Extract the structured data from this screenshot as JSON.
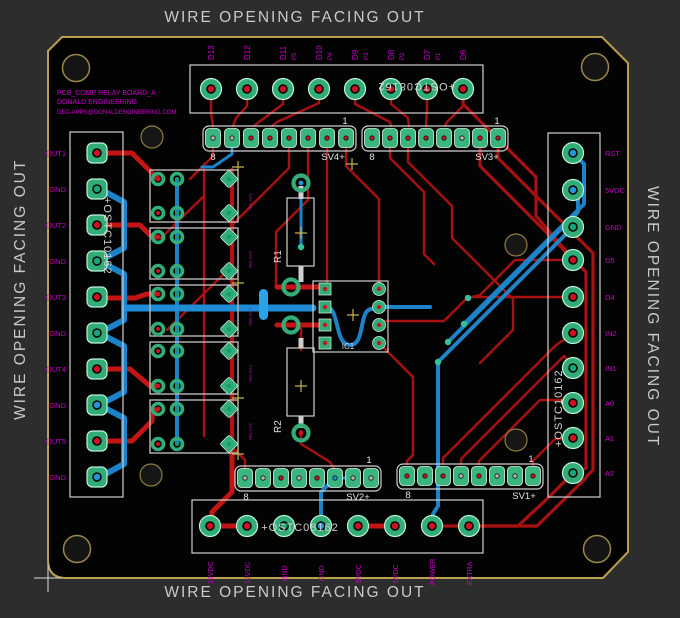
{
  "edge_labels": {
    "top": "WIRE OPENING FACING OUT",
    "bottom": "WIRE OPENING FACING OUT",
    "left": "WIRE OPENING FACING OUT",
    "right": "WIRE OPENING FACING OUT"
  },
  "title_block": {
    "line1": "PCB_COMP RELAY BOARD_A",
    "line2": "DONALD ENGINEERING",
    "line3": "DEC-APPS@DONALDENGINEERING.COM"
  },
  "top_connector": {
    "part": "+OSTC08162",
    "pins": [
      "D13",
      "D12",
      "D11",
      "D10",
      "D9",
      "D8",
      "D7",
      "D6"
    ],
    "sub_pins": [
      "P5",
      "P4",
      "P3",
      "P2",
      "P1"
    ]
  },
  "bottom_connector": {
    "part": "+OSTC08162",
    "pins": [
      "12VDC",
      "12VDC",
      "GND",
      "GND",
      "5VDC",
      "5VDC",
      "POWER",
      "EXTRA"
    ]
  },
  "left_connector": {
    "part": "+OSTC10162",
    "pins": [
      "OUT1",
      "GND",
      "OUT2",
      "GND",
      "OUT3",
      "GND",
      "OUT4",
      "GND",
      "OUT5",
      "GND"
    ]
  },
  "right_connector": {
    "part": "+OSTC10162",
    "pins": [
      "RST",
      "5VDC",
      "GND",
      "D5",
      "D4",
      "IN2",
      "IN1",
      "A0",
      "A1",
      "A2"
    ]
  },
  "headers": {
    "sv4": {
      "name": "SV4+",
      "first": "1",
      "last": "8"
    },
    "sv3": {
      "name": "SV3+",
      "first": "1",
      "last": "8"
    },
    "sv2": {
      "name": "SV2+",
      "first": "1",
      "last": "8"
    },
    "sv1": {
      "name": "SV1+",
      "first": "1",
      "last": "8"
    }
  },
  "components": {
    "r1": "R1",
    "r2": "R2",
    "ic1": "IC1",
    "relays": [
      "RELAY1",
      "RELAY2",
      "RELAY3",
      "RELAY4",
      "RELAY5"
    ]
  },
  "colors": {
    "background": "#2d2d2d",
    "board": "#030303",
    "board_outline": "#bda04d",
    "trace_red": "#a81111",
    "trace_blue": "#1d83c9",
    "pad_green": "#33ad77",
    "silkscreen": "#d0d0d0",
    "label_magenta": "#cc00cc"
  }
}
